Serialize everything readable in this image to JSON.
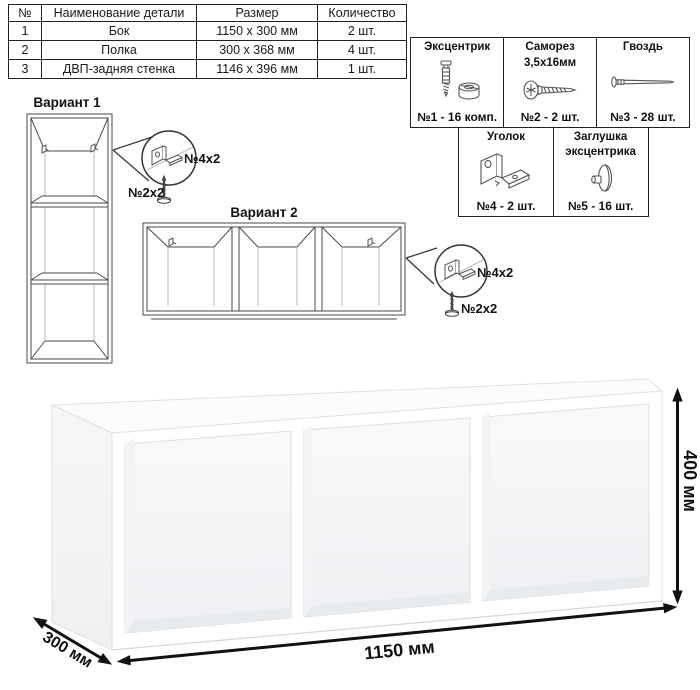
{
  "parts_table": {
    "headers": {
      "num": "№",
      "name": "Наименование детали",
      "size": "Размер",
      "qty": "Количество"
    },
    "rows": [
      {
        "num": "1",
        "name": "Бок",
        "size": "1150 x 300 мм",
        "qty": "2 шт."
      },
      {
        "num": "2",
        "name": "Полка",
        "size": "300 x 368 мм",
        "qty": "4 шт."
      },
      {
        "num": "3",
        "name": "ДВП-задняя стенка",
        "size": "1146 x 396 мм",
        "qty": "1 шт."
      }
    ]
  },
  "hardware": {
    "items": [
      {
        "title": "Эксцентрик",
        "title2": "",
        "qty": "№1 - 16 комп.",
        "icon": "cam-bolt-icon"
      },
      {
        "title": "Саморез",
        "title2": "3,5х16мм",
        "qty": "№2 - 2 шт.",
        "icon": "screw-icon"
      },
      {
        "title": "Гвоздь",
        "title2": "",
        "qty": "№3 - 28 шт.",
        "icon": "nail-icon"
      },
      {
        "title": "Уголок",
        "title2": "",
        "qty": "№4 - 2 шт.",
        "icon": "corner-bracket-icon"
      },
      {
        "title": "Заглушка",
        "title2": "эксцентрика",
        "qty": "№5 - 16 шт.",
        "icon": "cam-cap-icon"
      }
    ]
  },
  "variants": {
    "variant1_title": "Вариант 1",
    "variant2_title": "Вариант 2",
    "callout_bracket_label": "№4х2",
    "callout_screw_label": "№2х2"
  },
  "dimensions": {
    "width": "1150 мм",
    "height": "400 мм",
    "depth": "300 мм"
  },
  "colors": {
    "line": "#4a4a4a",
    "dimension": "#111111",
    "panel_white": "#ffffff",
    "panel_shade": "#eceef1"
  }
}
